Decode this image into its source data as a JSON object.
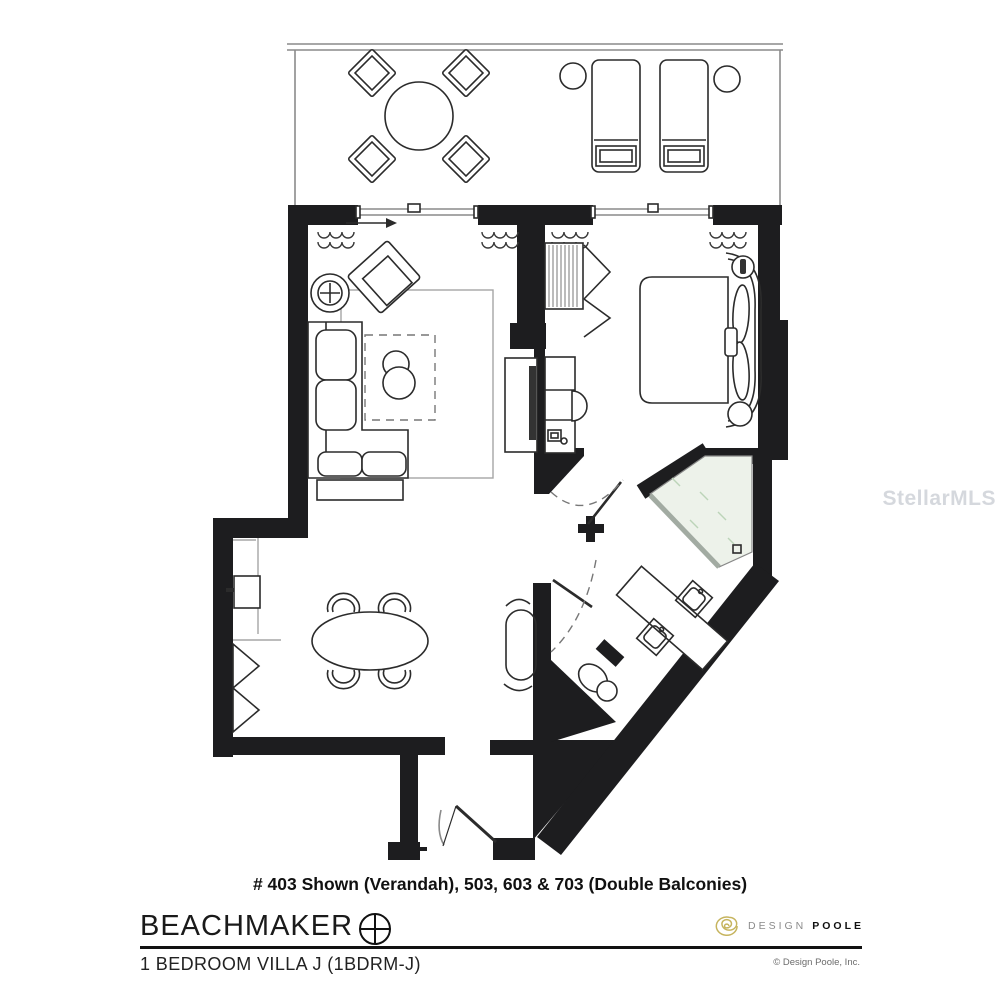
{
  "caption": "# 403 Shown (Verandah), 503, 603 & 703 (Double Balconies)",
  "brand": {
    "name": "BEACHMAKER"
  },
  "plan_subtitle": "1 BEDROOM VILLA J (1BDRM-J)",
  "designer_logo": {
    "word_design": "DESIGN",
    "word_poole": "POOLE"
  },
  "copyright": "© Design Poole, Inc.",
  "watermark": "StellarMLS",
  "colors": {
    "wall": "#1d1d1f",
    "line": "#2b2b2b",
    "thin": "#8a8a8a",
    "rug": "#a5a5a5",
    "shower": "#edf2ea",
    "glass": "#a2aba2",
    "spiral": "#c6b45e",
    "gray-text": "#8b8b8b",
    "watermark": "#d5d8dd",
    "copyright": "#6b6b6b"
  }
}
